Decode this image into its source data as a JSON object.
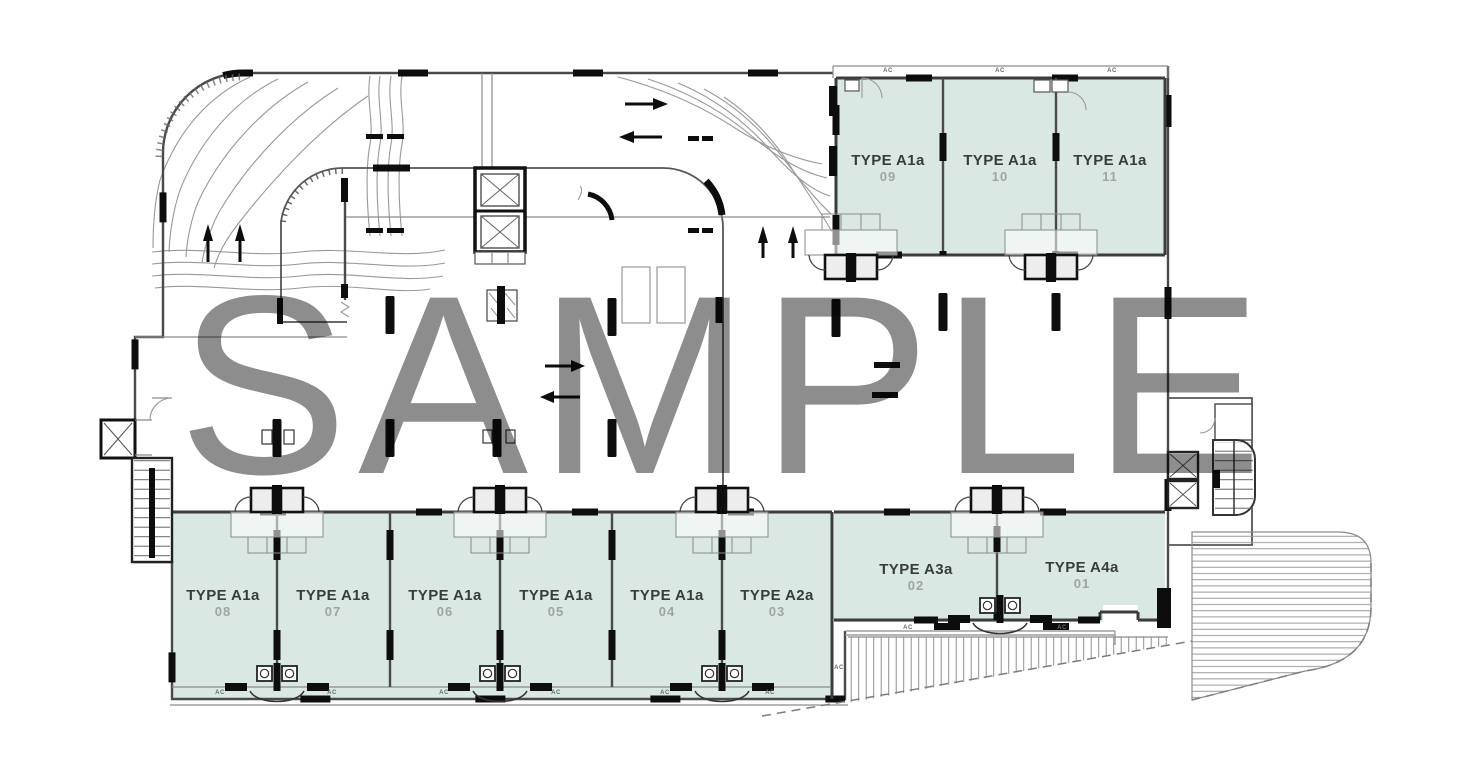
{
  "watermark": {
    "text": "SAMPLE"
  },
  "labels": {
    "ac": "AC"
  },
  "units": [
    {
      "label": "TYPE A1a",
      "number": "09"
    },
    {
      "label": "TYPE A1a",
      "number": "10"
    },
    {
      "label": "TYPE A1a",
      "number": "11"
    },
    {
      "label": "TYPE A1a",
      "number": "08"
    },
    {
      "label": "TYPE A1a",
      "number": "07"
    },
    {
      "label": "TYPE A1a",
      "number": "06"
    },
    {
      "label": "TYPE A1a",
      "number": "05"
    },
    {
      "label": "TYPE A1a",
      "number": "04"
    },
    {
      "label": "TYPE A2a",
      "number": "03"
    },
    {
      "label": "TYPE A3a",
      "number": "02"
    },
    {
      "label": "TYPE A4a",
      "number": "01"
    }
  ],
  "colors": {
    "unit_fill": "#d9e8e3",
    "wall": "#1f1f1f",
    "watermark_gray": "#8d8d8d",
    "number_gray": "#9ca6a1"
  }
}
